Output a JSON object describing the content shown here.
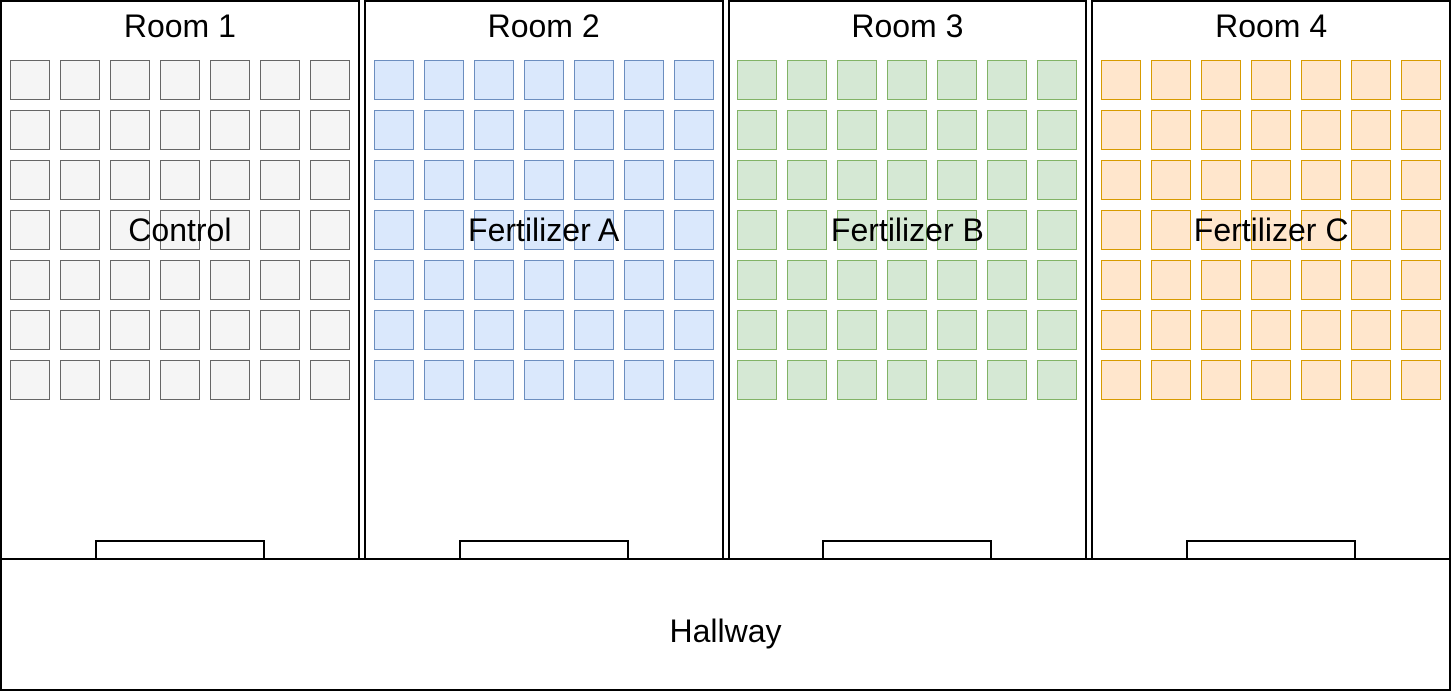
{
  "diagram_title": "Greenhouse experiment floor plan",
  "grid": {
    "rows": 7,
    "cols": 7,
    "cell_size_px": 40,
    "gap_px": 10
  },
  "rooms": [
    {
      "name": "Room 1",
      "treatment": "Control",
      "pot_fill": "#f5f5f5",
      "pot_stroke": "#666666",
      "pot_count": 49
    },
    {
      "name": "Room 2",
      "treatment": "Fertilizer A",
      "pot_fill": "#dae8fc",
      "pot_stroke": "#6c8ebf",
      "pot_count": 49
    },
    {
      "name": "Room 3",
      "treatment": "Fertilizer B",
      "pot_fill": "#d5e8d4",
      "pot_stroke": "#82b366",
      "pot_count": 49
    },
    {
      "name": "Room 4",
      "treatment": "Fertilizer C",
      "pot_fill": "#ffe6cc",
      "pot_stroke": "#d79b00",
      "pot_count": 49
    }
  ],
  "hallway": {
    "label": "Hallway"
  },
  "colors": {
    "wall_outline": "#000000",
    "background": "#ffffff",
    "text": "#000000"
  }
}
